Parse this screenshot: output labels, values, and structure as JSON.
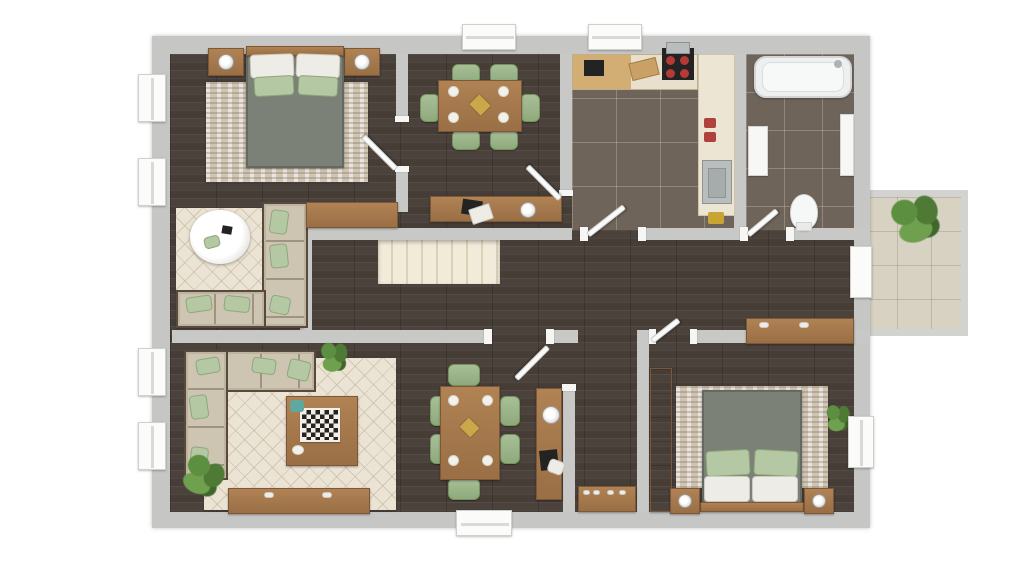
{
  "meta": {
    "title": "3D apartment floor plan, top-down view",
    "style": "rendered 3D floor plan",
    "background": "#ffffff"
  },
  "palette": {
    "outer_wall": "#c6c6c4",
    "inner_wall": "#c8c8c6",
    "wood_floor": "#4c423c",
    "kitchen_bath_tile": "#6f645a",
    "balcony_tile": "#d8d2c3",
    "rug_beige": "#ebe3d4",
    "rug_streaked": "#cec5b5",
    "sofa_beige": "#cdc4b1",
    "furniture_wood": "#a87c52",
    "bed_blanket": "#7b8177",
    "accent_green": "#a8bf97",
    "stairs": "#f3ebda",
    "door_white": "#fafafa",
    "plant_green": "#5d8f41"
  },
  "rooms": [
    {
      "id": "bedroom-1",
      "name": "Bedroom (top left)",
      "floor": "dark wood",
      "furniture": [
        "double bed with gray blanket",
        "2 white pillows",
        "2 green pillows",
        "2 wooden nightstands with lamps",
        "streaked beige rug"
      ]
    },
    {
      "id": "dining-room",
      "name": "Dining room (top middle)",
      "floor": "dark wood",
      "furniture": [
        "wooden dining table",
        "6 green chairs",
        "4 white plates",
        "gold centerpiece",
        "desk with laptop, papers and lamp"
      ]
    },
    {
      "id": "kitchen",
      "name": "Kitchen (top right)",
      "floor": "dark tile",
      "furniture": [
        "L-shaped counter",
        "black sink",
        "cutting board",
        "stove with red burners",
        "stainless sink",
        "red jars"
      ]
    },
    {
      "id": "bathroom",
      "name": "Bathroom (top far right)",
      "floor": "dark tile",
      "furniture": [
        "bathtub",
        "white cabinet",
        "white wall shelf",
        "toilet"
      ]
    },
    {
      "id": "sitting-area",
      "name": "Sitting area (middle left)",
      "floor": "dark wood",
      "furniture": [
        "L-shaped beige sectional sofa",
        "green pillows",
        "round white coffee table",
        "diamond-pattern rug",
        "wooden sideboard"
      ]
    },
    {
      "id": "hallway",
      "name": "Hallway (center)",
      "floor": "dark wood",
      "furniture": [
        "staircase"
      ]
    },
    {
      "id": "living-room",
      "name": "Living room (bottom left)",
      "floor": "dark wood",
      "furniture": [
        "L-shaped beige sectional sofa",
        "green pillows",
        "wooden coffee table with checkerboard",
        "diamond-pattern rug",
        "TV sideboard",
        "2 potted plants"
      ]
    },
    {
      "id": "dining-area-2",
      "name": "Second dining area (bottom middle)",
      "floor": "dark wood",
      "furniture": [
        "wooden dining table",
        "6 green chairs",
        "4 white plates",
        "wooden console with lamp and chair"
      ]
    },
    {
      "id": "entry-corridor",
      "name": "Entry corridor (bottom center)",
      "floor": "dark wood",
      "furniture": [
        "shoe console with white shoes",
        "entrance door"
      ]
    },
    {
      "id": "bedroom-2",
      "name": "Bedroom (bottom right)",
      "floor": "dark wood",
      "furniture": [
        "double bed with gray blanket",
        "2 white pillows",
        "2 green pillows",
        "2 wooden nightstands with lamps",
        "streaked beige rug",
        "wooden wardrobe",
        "wooden shelf",
        "potted plant"
      ]
    },
    {
      "id": "balcony",
      "name": "Balcony (right, outside)",
      "floor": "light tile",
      "furniture": [
        "large potted plant"
      ]
    }
  ],
  "openings": {
    "windows": [
      "left wall x4",
      "top wall x2",
      "right wall x1"
    ],
    "doors": [
      "bedroom-1 door",
      "dining-room door",
      "kitchen door",
      "bathroom door",
      "living-room door",
      "bedroom-2 door",
      "balcony door",
      "entrance door (bottom)"
    ]
  }
}
